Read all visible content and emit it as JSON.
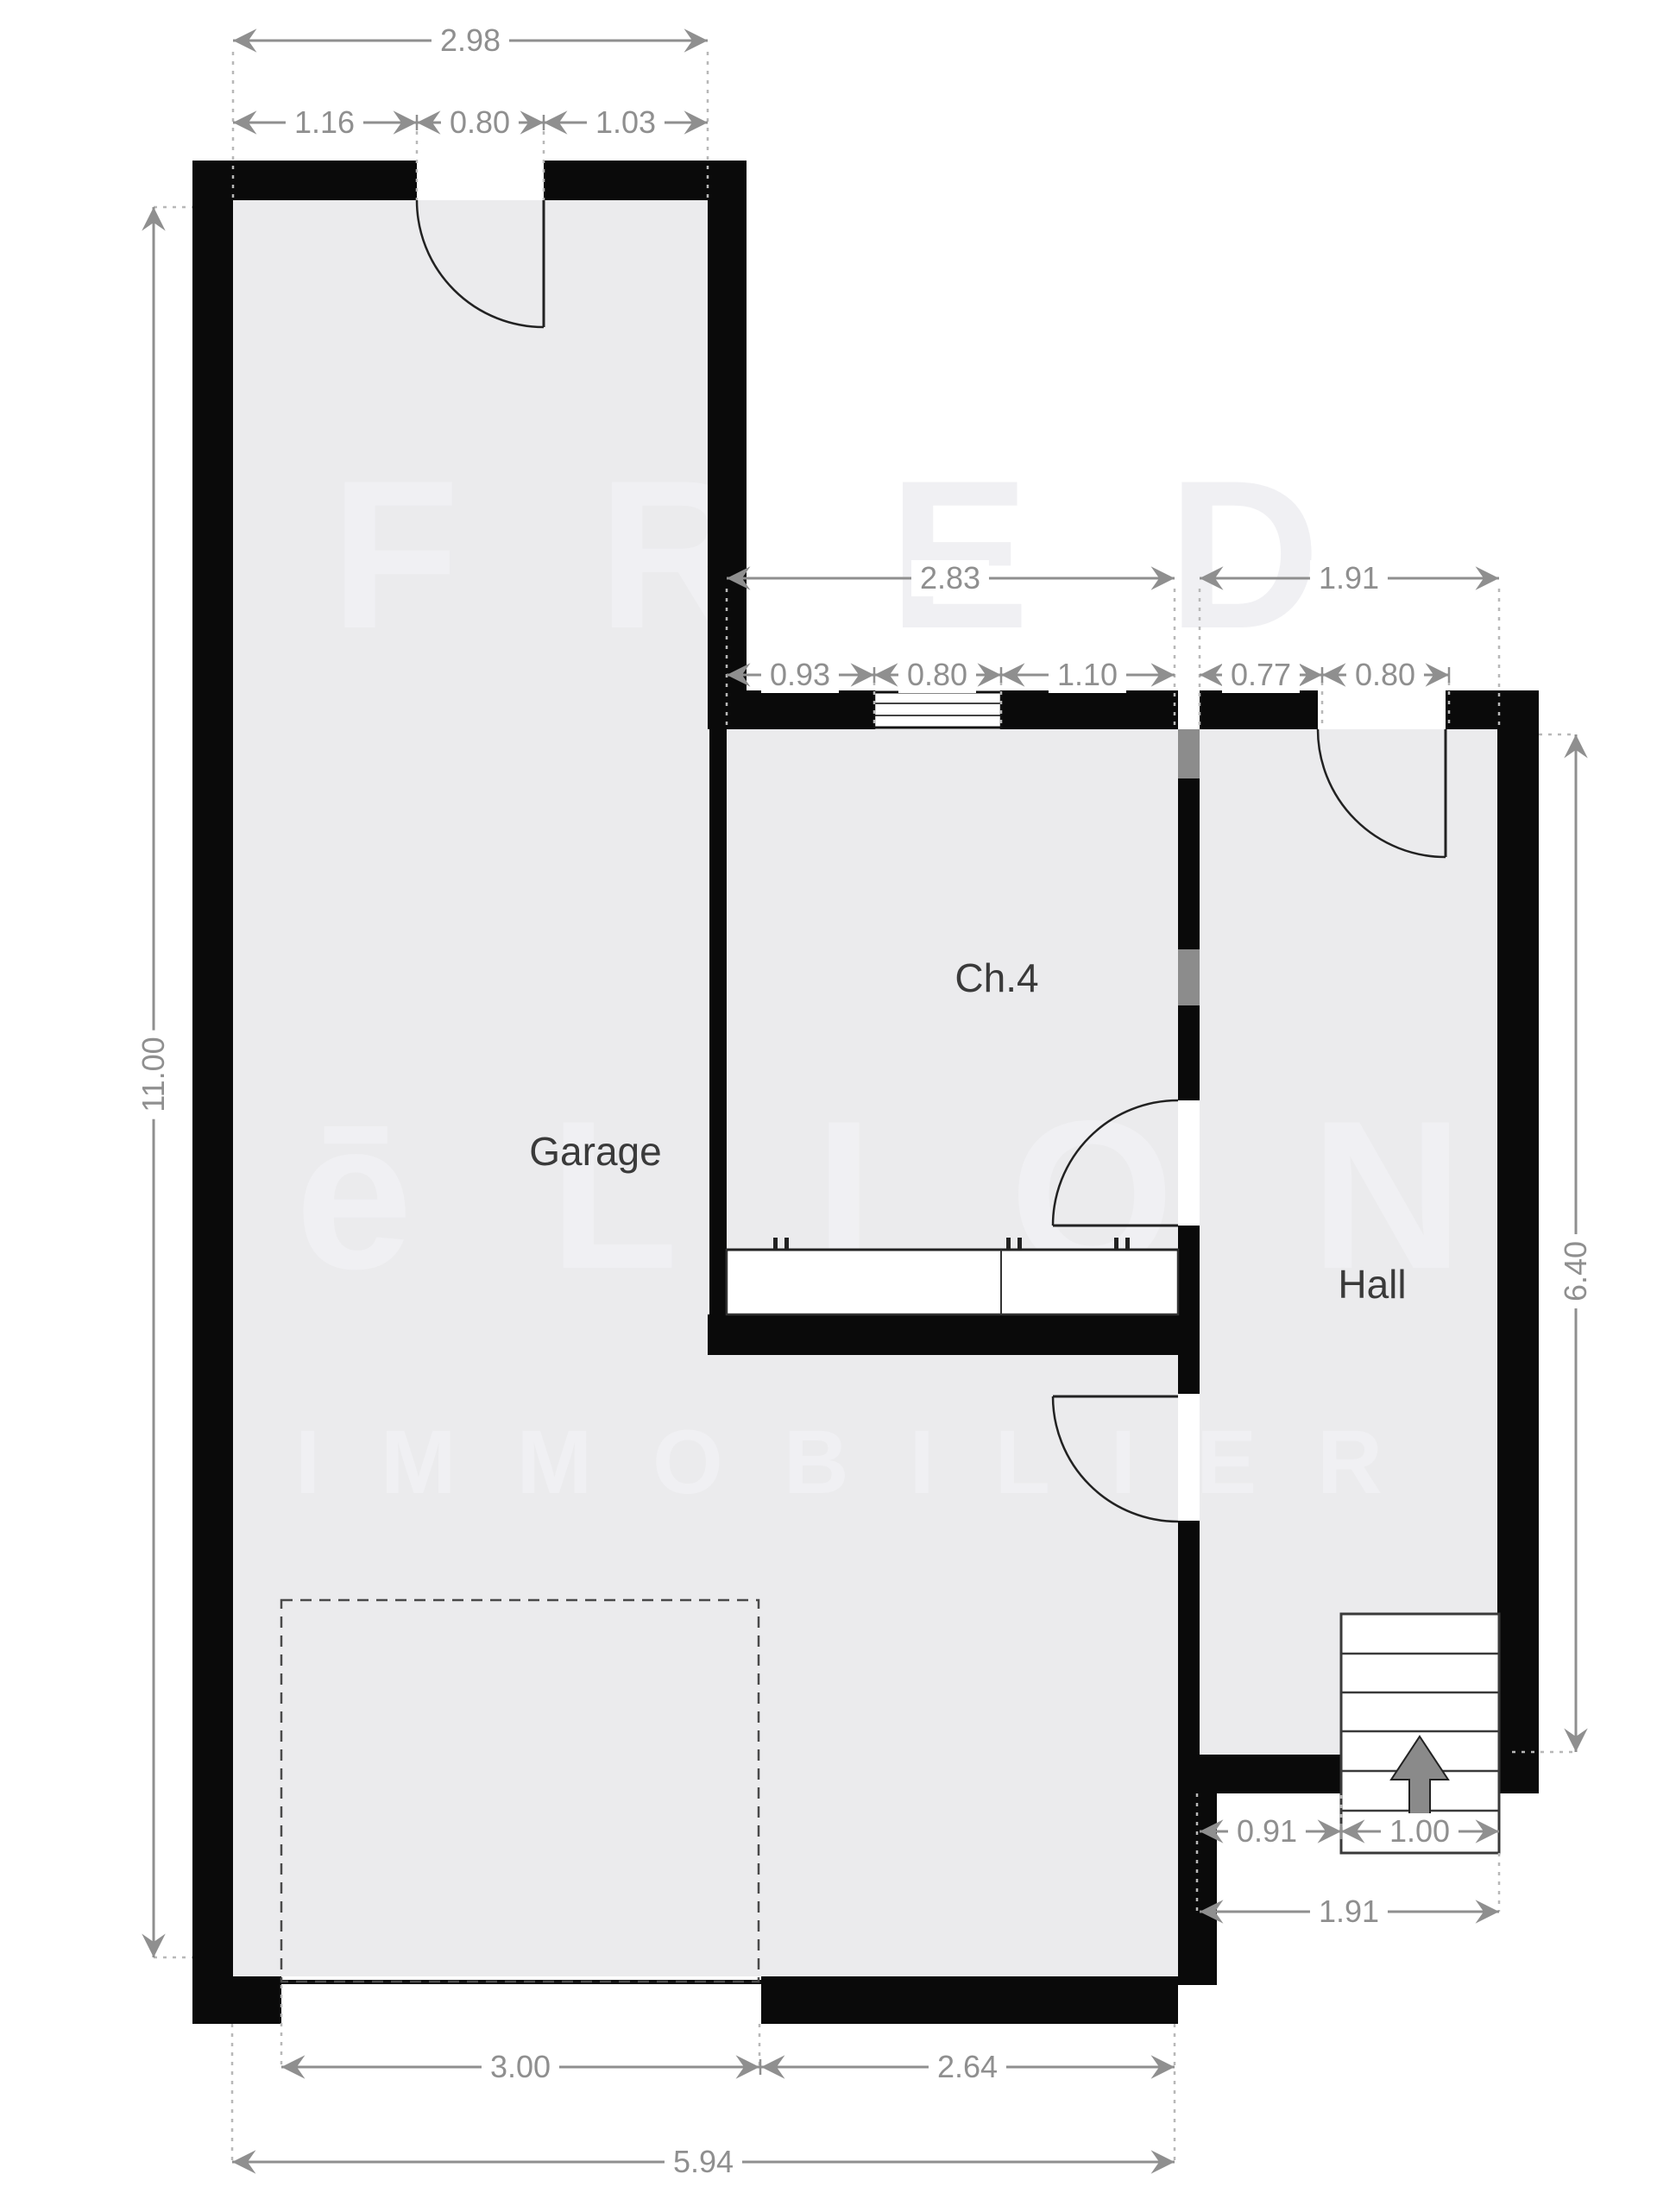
{
  "plan": {
    "rooms": {
      "garage": "Garage",
      "bedroom": "Ch.4",
      "hall": "Hall"
    },
    "watermark": {
      "line1": "FRED",
      "line2": "ēLION",
      "line3": "IMMOBILIER"
    },
    "dimensions": {
      "top_total": "2.98",
      "top_parts": [
        "1.16",
        "0.80",
        "1.03"
      ],
      "ch4_total": "2.83",
      "ch4_parts": [
        "0.93",
        "0.80",
        "1.10"
      ],
      "hall_total": "1.91",
      "hall_parts": [
        "0.77",
        "0.80"
      ],
      "left_height": "11.00",
      "right_height": "6.40",
      "landing_left": "0.91",
      "stairs_width": "1.00",
      "landing_total": "1.91",
      "garage_door": "3.00",
      "bottom_wall": "2.64",
      "bottom_total": "5.94"
    },
    "colors": {
      "wall": "#0a0a0a",
      "floor": "#ebebed",
      "dimension": "#8f8f8f",
      "room_label": "#3a3a3a",
      "watermark": "#f0f0f3",
      "stairs_arrow": "#8a8a8a"
    }
  }
}
